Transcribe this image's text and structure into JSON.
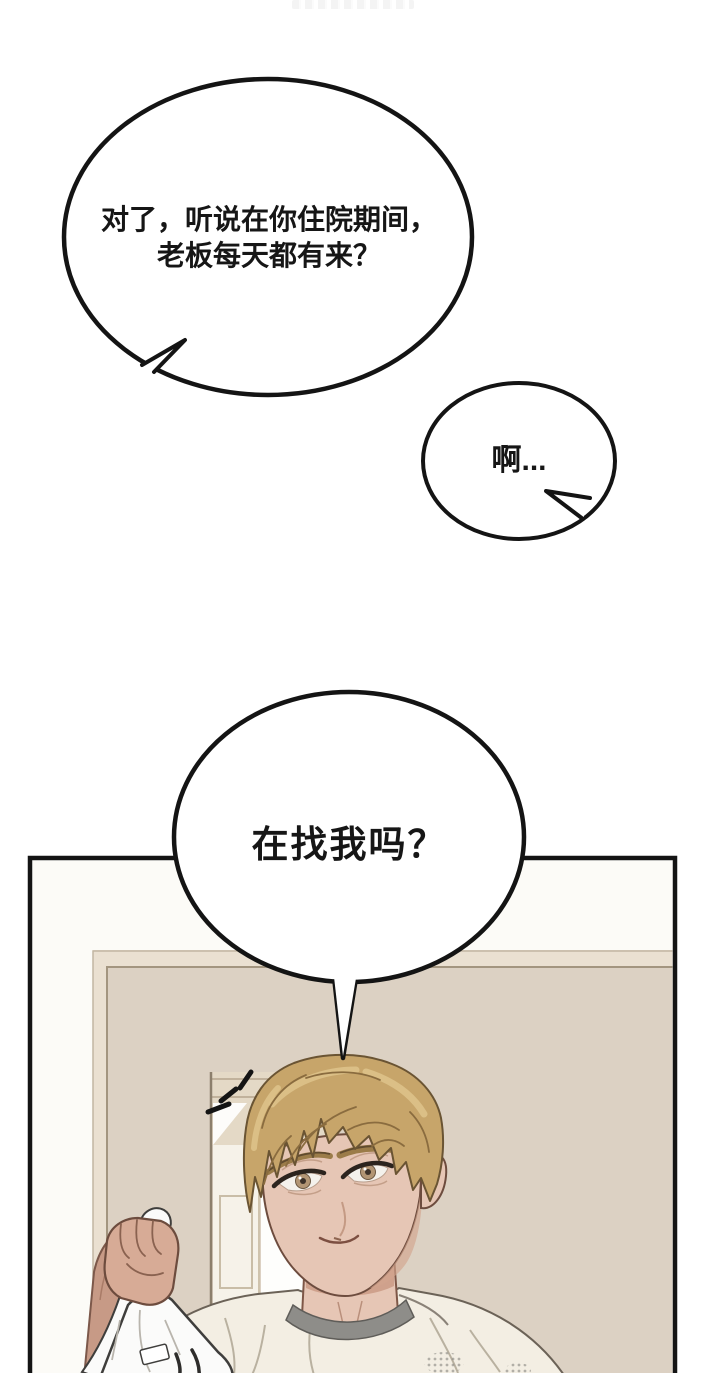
{
  "page_type": "manhwa-comic-page",
  "bubbles": {
    "bubble1": {
      "line1": "对了，听说在你住院期间，",
      "line2": "老板每天都有来？"
    },
    "bubble2": {
      "text": "啊..."
    },
    "bubble3": {
      "text": "在找我吗？"
    }
  },
  "colors": {
    "ink": "#141414",
    "bubble_fill": "#ffffff",
    "panel_bg": "#fcfbf7",
    "wall": "#dcd1c3",
    "wall_light": "#eae0d1",
    "wall_trim": "#a3957f",
    "lintel": "#e4d9c6",
    "door": "#f6f2e9",
    "door_light": "#fefefc",
    "skin": "#e6c6b5",
    "skin_shadow": "#d2a48e",
    "arm": "#c79a86",
    "hand": "#d7ab96",
    "hair": "#c7a56a",
    "hair_highlight": "#ddc28a",
    "hair_dark": "#8a6c3f",
    "shirt": "#f3eee3",
    "collar": "#8e8d89",
    "bag": "#fbfbfa",
    "iris": "#b29574"
  }
}
